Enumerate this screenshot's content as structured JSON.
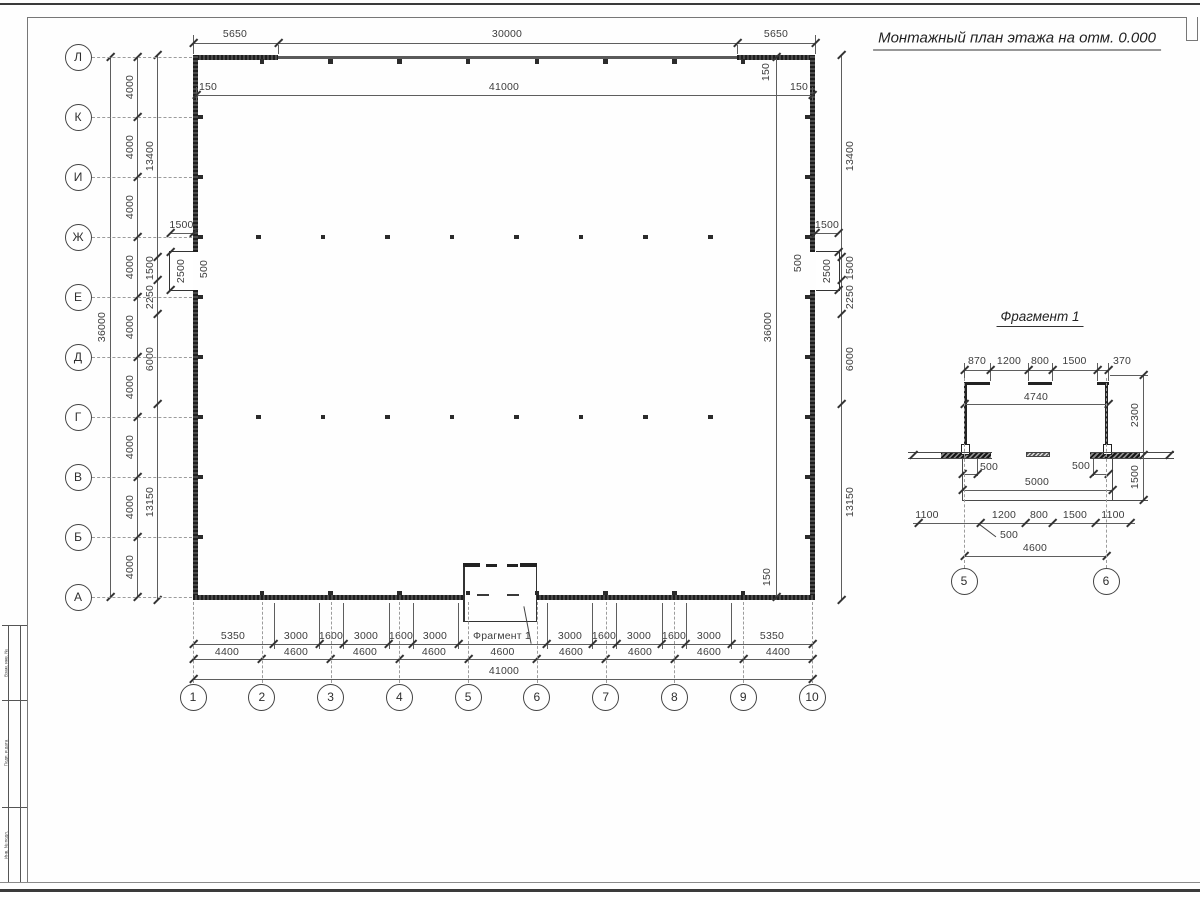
{
  "sheet": {
    "title": "Монтажный план этажа на отм. 0.000",
    "stamp_labels": [
      "Взам. инв. №",
      "Подп. и дата",
      "Инв. № подл."
    ]
  },
  "plan": {
    "row_axes": [
      "Л",
      "К",
      "И",
      "Ж",
      "Е",
      "Д",
      "Г",
      "В",
      "Б",
      "А"
    ],
    "col_axes": [
      "1",
      "2",
      "3",
      "4",
      "5",
      "6",
      "7",
      "8",
      "9",
      "10"
    ],
    "top_row1": [
      "5650",
      "30000",
      "5650"
    ],
    "top_row2_left": "150",
    "top_row2_mid": "41000",
    "top_row2_right": "150",
    "top_right_150": "150",
    "bottom_right_150": "150",
    "left_overall": "36000",
    "right_overall": "36000",
    "left_4000": [
      "4000",
      "4000",
      "4000",
      "4000",
      "4000",
      "4000",
      "4000",
      "4000",
      "4000"
    ],
    "left_chain": [
      "13400",
      "1500",
      "2250",
      "6000",
      "13150"
    ],
    "right_chain": [
      "13400",
      "1500",
      "2250",
      "6000",
      "13150"
    ],
    "left_prot": {
      "w": "1500",
      "h": "2500",
      "o": "500"
    },
    "right_prot": {
      "w": "1500",
      "h": "2500",
      "o": "500"
    },
    "bottom_row1": [
      "5350",
      "3000",
      "1600",
      "3000",
      "1600",
      "3000",
      "3000",
      "1600",
      "3000",
      "1600",
      "3000",
      "5350"
    ],
    "fragment_label": "Фрагмент 1",
    "bottom_row2": [
      "4400",
      "4600",
      "4600",
      "4600",
      "4600",
      "4600",
      "4600",
      "4600",
      "4400"
    ],
    "bottom_total": "41000"
  },
  "fragment": {
    "title": "Фрагмент 1",
    "axes": [
      "5",
      "6"
    ],
    "top_dims": [
      "870",
      "1200",
      "800",
      "1500",
      "370"
    ],
    "width_top": "4740",
    "height_right": "2300",
    "left_500": "500",
    "right_500": "500",
    "right_1500": "1500",
    "width_mid": "5000",
    "bottom_dims": [
      "1100",
      "1200",
      "800",
      "1500",
      "1100"
    ],
    "leader_500": "500",
    "width_bottom": "4600"
  }
}
